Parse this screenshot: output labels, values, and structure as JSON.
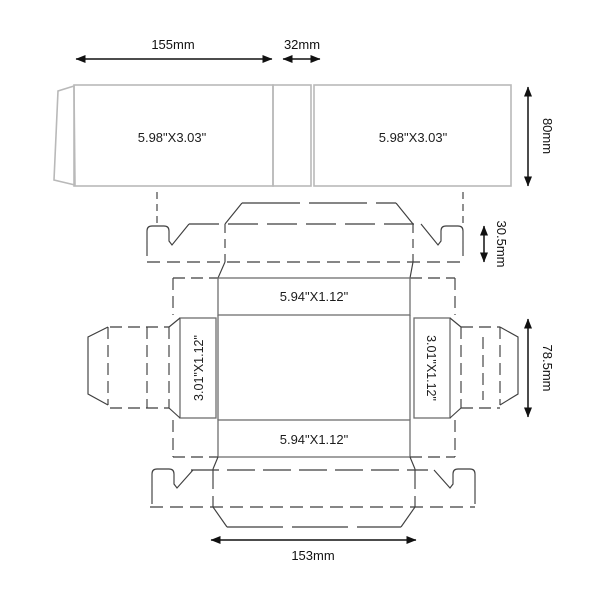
{
  "diagram": {
    "type": "packaging-box-dieline",
    "dimensions": {
      "top_width": "155mm",
      "top_gap": "32mm",
      "top_height": "80mm",
      "tuck_height": "30.5mm",
      "body_height": "78.5mm",
      "body_width": "153mm"
    },
    "panels": {
      "top_left": "5.98\"X3.03\"",
      "top_right": "5.98\"X3.03\"",
      "band_top": "5.94\"X1.12\"",
      "band_bottom": "5.94\"X1.12\"",
      "side_left": "3.01\"X1.12\"",
      "side_right": "3.01\"X1.12\""
    },
    "colors": {
      "background": "#ffffff",
      "outline_light": "#b9b9b9",
      "outline_mid": "#6e6e6e",
      "outline_dark": "#3f3f3f",
      "dimension": "#111111"
    }
  }
}
